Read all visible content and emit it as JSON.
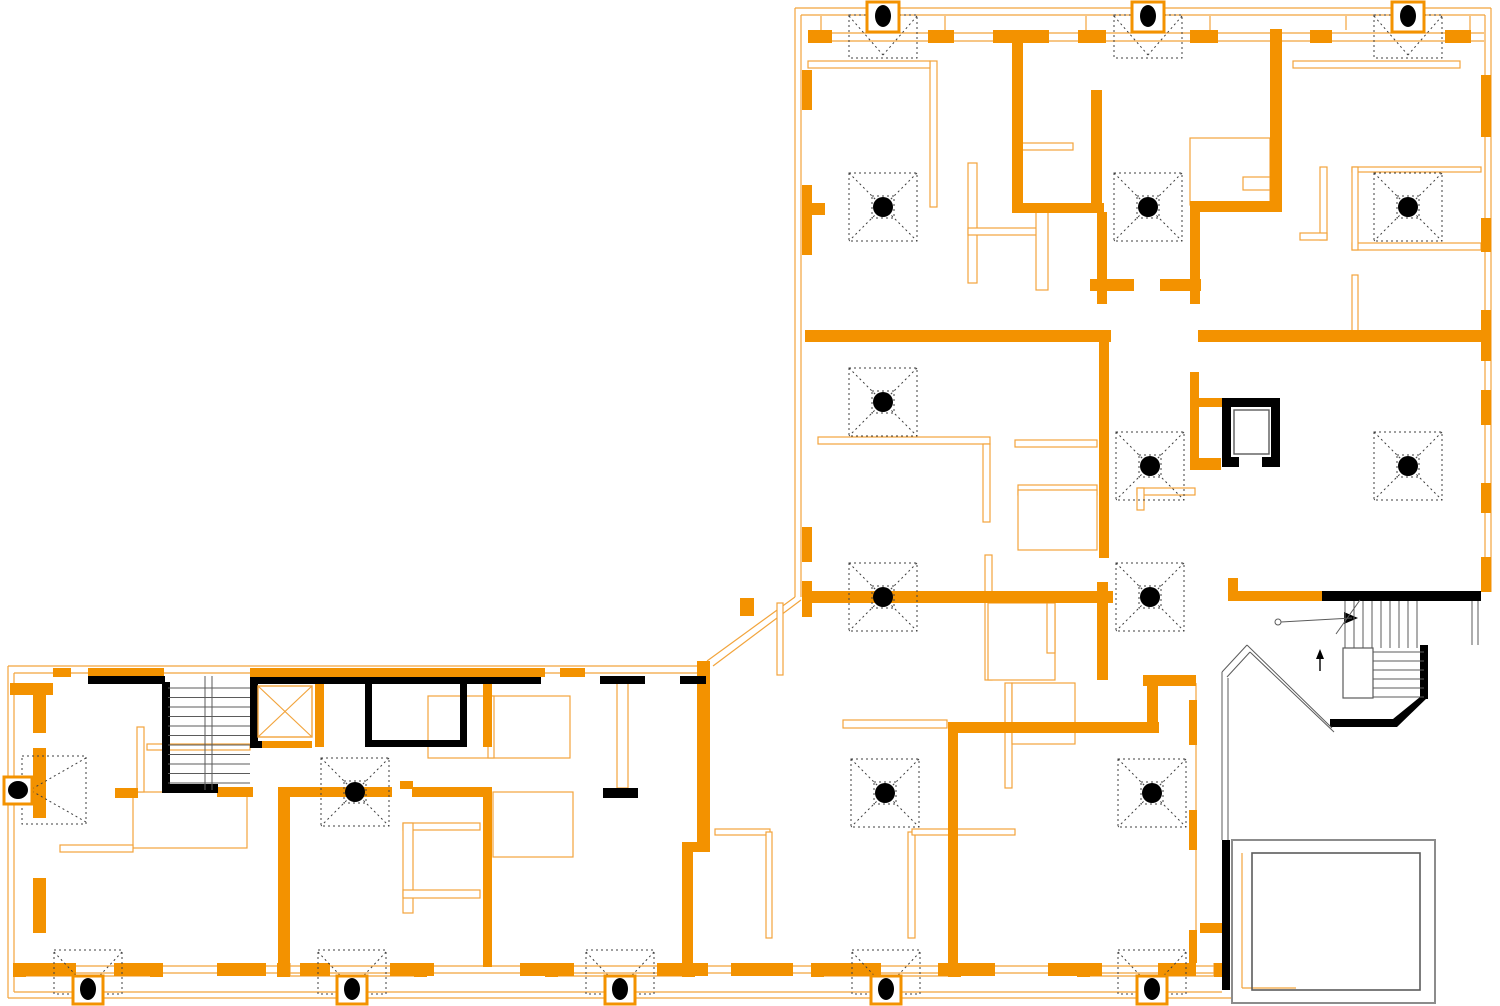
{
  "meta": {
    "kind": "architectural-floor-plan",
    "canvas_width": 1500,
    "canvas_height": 1006
  },
  "colors": {
    "wall": "#F39200",
    "line": "#F2A43C",
    "black": "#000000",
    "gray": "#5B5B5B",
    "grayLight": "#8C8C8C",
    "white": "#FFFFFF",
    "dash": "#3F3F3F"
  },
  "walls_orange": [
    [
      1012,
      30,
      11,
      182
    ],
    [
      1012,
      203,
      92,
      10
    ],
    [
      1091,
      90,
      11,
      115
    ],
    [
      1097,
      212,
      10,
      92
    ],
    [
      1090,
      279,
      44,
      12
    ],
    [
      1160,
      279,
      41,
      12
    ],
    [
      1270,
      29,
      12,
      182
    ],
    [
      1190,
      201,
      92,
      11
    ],
    [
      1190,
      212,
      10,
      92
    ],
    [
      805,
      330,
      306,
      12
    ],
    [
      1099,
      342,
      10,
      216
    ],
    [
      1097,
      582,
      11,
      98
    ],
    [
      810,
      591,
      303,
      12
    ],
    [
      1190,
      372,
      9,
      98
    ],
    [
      1190,
      458,
      31,
      12
    ],
    [
      1198,
      330,
      286,
      12
    ],
    [
      1143,
      675,
      53,
      11
    ],
    [
      1147,
      683,
      11,
      50
    ],
    [
      948,
      722,
      211,
      11
    ],
    [
      948,
      733,
      10,
      237
    ],
    [
      1228,
      578,
      10,
      16
    ],
    [
      1228,
      591,
      95,
      10
    ],
    [
      1190,
      398,
      33,
      9
    ],
    [
      808,
      30,
      24,
      13
    ],
    [
      928,
      30,
      26,
      13
    ],
    [
      993,
      30,
      56,
      13
    ],
    [
      1078,
      30,
      28,
      13
    ],
    [
      1190,
      30,
      28,
      13
    ],
    [
      1310,
      30,
      22,
      13
    ],
    [
      1445,
      30,
      26,
      13
    ],
    [
      802,
      70,
      10,
      40
    ],
    [
      802,
      185,
      10,
      70
    ],
    [
      805,
      203,
      20,
      12
    ],
    [
      802,
      527,
      10,
      35
    ],
    [
      802,
      581,
      10,
      36
    ],
    [
      1481,
      75,
      10,
      62
    ],
    [
      1481,
      218,
      10,
      34
    ],
    [
      1481,
      310,
      10,
      51
    ],
    [
      1481,
      390,
      10,
      35
    ],
    [
      1481,
      483,
      10,
      30
    ],
    [
      1481,
      557,
      10,
      35
    ],
    [
      88,
      668,
      76,
      9
    ],
    [
      250,
      668,
      295,
      9
    ],
    [
      53,
      668,
      18,
      9
    ],
    [
      560,
      668,
      25,
      9
    ],
    [
      10,
      683,
      43,
      12
    ],
    [
      315,
      681,
      9,
      66
    ],
    [
      483,
      681,
      9,
      66
    ],
    [
      483,
      787,
      9,
      180
    ],
    [
      115,
      788,
      23,
      10
    ],
    [
      217,
      787,
      36,
      10
    ],
    [
      278,
      787,
      114,
      10
    ],
    [
      400,
      781,
      13,
      8
    ],
    [
      412,
      787,
      77,
      10
    ],
    [
      278,
      792,
      12,
      174
    ],
    [
      697,
      661,
      13,
      190
    ],
    [
      682,
      842,
      28,
      10
    ],
    [
      682,
      842,
      11,
      129
    ],
    [
      740,
      598,
      14,
      18
    ],
    [
      262,
      741,
      50,
      7
    ],
    [
      20,
      963,
      56,
      13
    ],
    [
      114,
      963,
      48,
      13
    ],
    [
      217,
      963,
      49,
      13
    ],
    [
      300,
      963,
      30,
      13
    ],
    [
      390,
      963,
      44,
      13
    ],
    [
      520,
      963,
      54,
      13
    ],
    [
      657,
      963,
      51,
      13
    ],
    [
      731,
      963,
      62,
      13
    ],
    [
      823,
      963,
      58,
      13
    ],
    [
      938,
      963,
      57,
      13
    ],
    [
      1048,
      963,
      54,
      13
    ],
    [
      1158,
      963,
      38,
      13
    ],
    [
      13,
      963,
      13,
      14
    ],
    [
      150,
      963,
      13,
      14
    ],
    [
      277,
      963,
      13,
      14
    ],
    [
      414,
      963,
      13,
      14
    ],
    [
      545,
      963,
      13,
      14
    ],
    [
      682,
      963,
      13,
      14
    ],
    [
      811,
      963,
      13,
      14
    ],
    [
      948,
      963,
      13,
      14
    ],
    [
      1077,
      963,
      13,
      14
    ],
    [
      1214,
      963,
      13,
      14
    ],
    [
      33,
      688,
      13,
      45
    ],
    [
      33,
      748,
      13,
      70
    ],
    [
      33,
      878,
      13,
      55
    ],
    [
      1189,
      700,
      8,
      45
    ],
    [
      1189,
      810,
      8,
      40
    ],
    [
      1189,
      930,
      8,
      33
    ],
    [
      1200,
      923,
      22,
      10
    ]
  ],
  "walls_black": [
    [
      88,
      676,
      77,
      8
    ],
    [
      253,
      677,
      288,
      7
    ],
    [
      600,
      676,
      45,
      8
    ],
    [
      680,
      676,
      26,
      8
    ],
    [
      162,
      682,
      8,
      111
    ],
    [
      162,
      784,
      56,
      9
    ],
    [
      250,
      677,
      8,
      71
    ],
    [
      250,
      741,
      12,
      7
    ],
    [
      365,
      681,
      7,
      66
    ],
    [
      460,
      681,
      7,
      66
    ],
    [
      365,
      740,
      102,
      7
    ],
    [
      603,
      788,
      35,
      10
    ],
    [
      1322,
      591,
      159,
      10
    ],
    [
      1420,
      645,
      8,
      54
    ],
    [
      1222,
      840,
      8,
      150
    ],
    [
      1222,
      398,
      58,
      9
    ],
    [
      1222,
      398,
      9,
      60
    ],
    [
      1271,
      398,
      9,
      60
    ],
    [
      1222,
      457,
      17,
      10
    ],
    [
      1262,
      457,
      18,
      10
    ]
  ],
  "polys_black": [
    "1420,697 1428,697 1397,727 1330,727 1330,719 1393,719",
    "1316,659 1324,659 1320,649",
    "1344,612 1358,618 1344,624"
  ],
  "partitions": [
    [
      930,
      61,
      7,
      146
    ],
    [
      968,
      163,
      9,
      120
    ],
    [
      968,
      228,
      69,
      7
    ],
    [
      1036,
      210,
      12,
      80
    ],
    [
      1017,
      143,
      56,
      7
    ],
    [
      1190,
      138,
      80,
      67
    ],
    [
      1243,
      177,
      27,
      13
    ],
    [
      1320,
      167,
      7,
      73
    ],
    [
      1300,
      233,
      27,
      7
    ],
    [
      1352,
      167,
      129,
      5
    ],
    [
      1352,
      243,
      129,
      7
    ],
    [
      1352,
      167,
      6,
      83
    ],
    [
      1352,
      275,
      6,
      58
    ],
    [
      818,
      437,
      172,
      7
    ],
    [
      983,
      444,
      7,
      78
    ],
    [
      1015,
      440,
      82,
      7
    ],
    [
      1018,
      485,
      79,
      10
    ],
    [
      1018,
      490,
      79,
      60
    ],
    [
      1137,
      488,
      58,
      7
    ],
    [
      1137,
      488,
      7,
      22
    ],
    [
      985,
      555,
      7,
      125
    ],
    [
      988,
      603,
      67,
      77
    ],
    [
      1047,
      603,
      8,
      50
    ],
    [
      843,
      720,
      104,
      8
    ],
    [
      777,
      603,
      6,
      72
    ],
    [
      808,
      61,
      122,
      7
    ],
    [
      1293,
      61,
      167,
      7
    ],
    [
      133,
      792,
      114,
      56
    ],
    [
      60,
      845,
      73,
      7
    ],
    [
      137,
      727,
      7,
      65
    ],
    [
      147,
      744,
      103,
      6
    ],
    [
      403,
      823,
      77,
      7
    ],
    [
      403,
      823,
      10,
      90
    ],
    [
      403,
      890,
      77,
      8
    ],
    [
      493,
      792,
      80,
      65
    ],
    [
      617,
      683,
      11,
      105
    ],
    [
      715,
      829,
      55,
      6
    ],
    [
      766,
      832,
      6,
      106
    ],
    [
      908,
      832,
      7,
      106
    ],
    [
      912,
      829,
      103,
      6
    ],
    [
      1005,
      683,
      7,
      105
    ],
    [
      1012,
      683,
      63,
      61
    ],
    [
      428,
      696,
      142,
      62
    ],
    [
      488,
      696,
      6,
      62
    ]
  ],
  "lines_orange": [
    [
      795,
      8,
      1491,
      8
    ],
    [
      801,
      15,
      1485,
      15
    ],
    [
      1491,
      8,
      1491,
      592
    ],
    [
      1485,
      15,
      1485,
      592
    ],
    [
      795,
      8,
      795,
      597
    ],
    [
      801,
      15,
      801,
      597
    ],
    [
      795,
      597,
      707,
      661
    ],
    [
      801,
      600,
      713,
      666
    ],
    [
      8,
      666,
      707,
      666
    ],
    [
      14,
      673,
      707,
      673
    ],
    [
      8,
      666,
      8,
      998
    ],
    [
      14,
      673,
      14,
      992
    ],
    [
      8,
      998,
      1232,
      998
    ],
    [
      14,
      992,
      1222,
      992
    ],
    [
      1196,
      683,
      1196,
      963
    ],
    [
      810,
      33,
      1484,
      33
    ],
    [
      810,
      41,
      1484,
      41
    ],
    [
      14,
      966,
      1222,
      966
    ],
    [
      14,
      973,
      1222,
      973
    ],
    [
      1242,
      853,
      1242,
      988
    ],
    [
      1242,
      988,
      1296,
      988
    ],
    [
      26,
      976,
      150,
      976
    ],
    [
      26,
      963,
      26,
      976
    ],
    [
      150,
      963,
      150,
      976
    ],
    [
      290,
      976,
      414,
      976
    ],
    [
      290,
      963,
      290,
      976
    ],
    [
      414,
      963,
      414,
      976
    ],
    [
      558,
      976,
      682,
      976
    ],
    [
      558,
      963,
      558,
      976
    ],
    [
      682,
      963,
      682,
      976
    ],
    [
      824,
      976,
      948,
      976
    ],
    [
      824,
      963,
      824,
      976
    ],
    [
      948,
      963,
      948,
      976
    ],
    [
      1090,
      976,
      1214,
      976
    ],
    [
      1090,
      963,
      1090,
      976
    ],
    [
      1214,
      963,
      1214,
      976
    ],
    [
      821,
      16,
      821,
      30
    ],
    [
      945,
      16,
      945,
      30
    ],
    [
      1086,
      16,
      1086,
      30
    ],
    [
      1210,
      16,
      1210,
      30
    ],
    [
      1346,
      16,
      1346,
      30
    ],
    [
      1470,
      16,
      1470,
      30
    ]
  ],
  "lines_gray": [
    [
      205,
      676,
      205,
      790
    ],
    [
      212,
      676,
      212,
      790
    ],
    [
      1222,
      672,
      1247,
      645
    ],
    [
      1247,
      645,
      1332,
      728
    ],
    [
      1227,
      677,
      1250,
      652
    ],
    [
      1250,
      652,
      1334,
      732
    ],
    [
      1222,
      672,
      1222,
      840
    ],
    [
      1228,
      678,
      1228,
      840
    ],
    [
      1472,
      601,
      1472,
      645
    ],
    [
      1478,
      601,
      1478,
      645
    ],
    [
      1336,
      634,
      1360,
      600
    ],
    [
      1281,
      622,
      1352,
      618
    ],
    [
      1234,
      410,
      1269,
      454
    ],
    [
      1269,
      410,
      1234,
      454
    ]
  ],
  "lines_black": [
    [
      1320,
      671,
      1320,
      659
    ]
  ],
  "tread_sets": [
    {
      "dir": "v",
      "from": 1345,
      "to": 1417,
      "step": 9,
      "a": 601,
      "b": 648
    },
    {
      "dir": "h",
      "from": 652,
      "to": 697,
      "step": 9,
      "a": 1373,
      "b": 1424
    },
    {
      "dir": "h",
      "from": 688,
      "to": 783,
      "step": 9.5,
      "a": 168,
      "b": 250
    }
  ],
  "rects_gray": [
    {
      "x": 1343,
      "y": 648,
      "w": 30,
      "h": 50,
      "fill": "white",
      "stroke": "gray",
      "sw": 1.2
    },
    {
      "x": 1232,
      "y": 840,
      "w": 203,
      "h": 163,
      "fill": "none",
      "stroke": "grayLight",
      "sw": 2
    },
    {
      "x": 1252,
      "y": 853,
      "w": 168,
      "h": 137,
      "fill": "none",
      "stroke": "gray",
      "sw": 1.6
    },
    {
      "x": 1234,
      "y": 410,
      "w": 35,
      "h": 44,
      "fill": "white",
      "stroke": "gray",
      "sw": 1.4
    }
  ],
  "circles_gray": [
    {
      "cx": 1278,
      "cy": 622,
      "r": 3
    }
  ],
  "elevator_cabs": [
    {
      "x": 258,
      "y": 686,
      "w": 54,
      "h": 51,
      "style": "orange"
    }
  ],
  "columns": {
    "full": [
      [
        883,
        207
      ],
      [
        1148,
        207
      ],
      [
        1408,
        207
      ],
      [
        883,
        402
      ],
      [
        1150,
        466
      ],
      [
        1408,
        466
      ],
      [
        883,
        597
      ],
      [
        1150,
        597
      ],
      [
        355,
        792
      ],
      [
        885,
        793
      ],
      [
        1152,
        793
      ]
    ],
    "top_edge": [
      883,
      1148,
      1408
    ],
    "bottom_edge": [
      88,
      352,
      620,
      886,
      1152
    ],
    "left_edge": [
      [
        18,
        790
      ]
    ]
  },
  "column_style": {
    "dot_r": 10,
    "marker_half": 34,
    "inner_half": 11,
    "top_cy": 16,
    "bottom_cy": 989
  }
}
